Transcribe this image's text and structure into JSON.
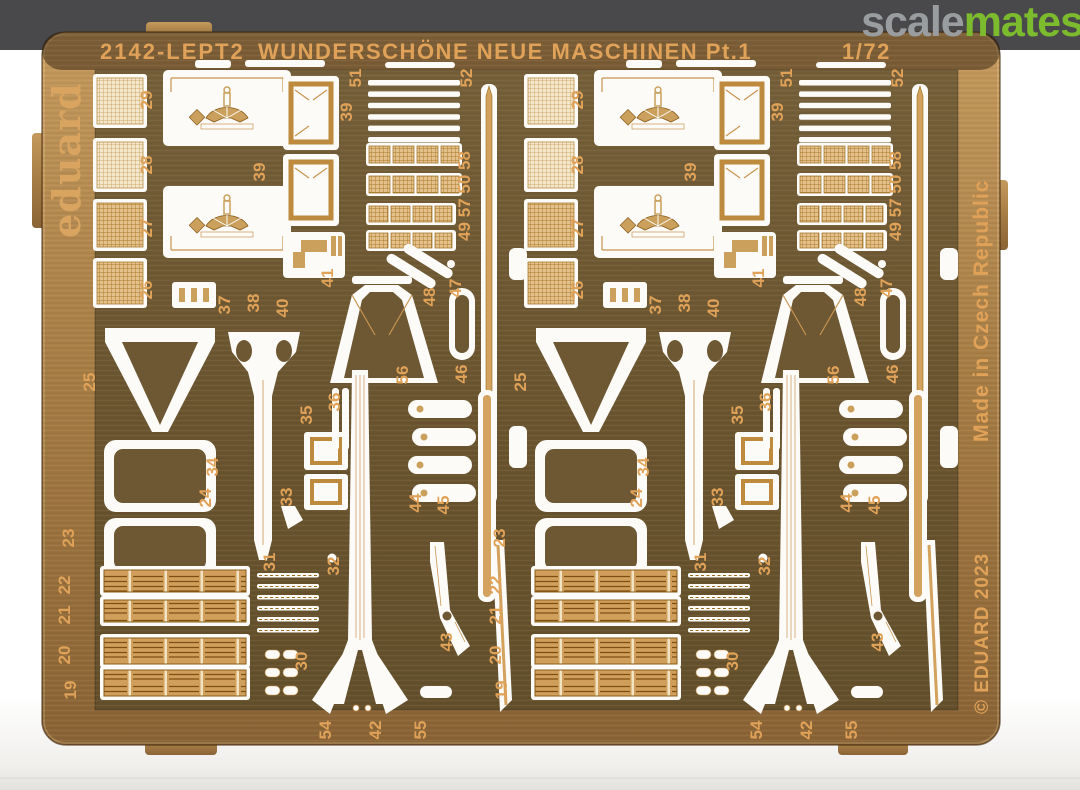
{
  "watermark": {
    "scale": "scale",
    "mates": "mates"
  },
  "board": {
    "code": "2142-LEPT2",
    "title": "WUNDERSCHÖNE NEUE MASCHINEN Pt.1",
    "scale_label": "1/72",
    "brand": "eduard",
    "made_in": "Made in Czech Republic",
    "copyright": "© EDUARD 2023"
  },
  "colors": {
    "band": "#49494b",
    "edge": "#bc9055",
    "field": "#6e5733",
    "etch": "#e0a258",
    "white_part": "#fcfbf7",
    "wm_gray": "#999da0",
    "wm_green": "#7cbb2d"
  },
  "part_labels": [
    {
      "t": "29",
      "x": 57,
      "y": 100
    },
    {
      "t": "28",
      "x": 57,
      "y": 165
    },
    {
      "t": "27",
      "x": 57,
      "y": 228
    },
    {
      "t": "26",
      "x": 57,
      "y": 290
    },
    {
      "t": "39",
      "x": 257,
      "y": 112
    },
    {
      "t": "39",
      "x": 170,
      "y": 172
    },
    {
      "t": "41",
      "x": 238,
      "y": 278
    },
    {
      "t": "51",
      "x": 266,
      "y": 78
    },
    {
      "t": "49 57 50 58",
      "x": 375,
      "y": 196
    },
    {
      "t": "52",
      "x": 377,
      "y": 78
    },
    {
      "t": "47",
      "x": 366,
      "y": 288
    },
    {
      "t": "48",
      "x": 340,
      "y": 297
    },
    {
      "t": "46",
      "x": 372,
      "y": 374
    },
    {
      "t": "56",
      "x": 313,
      "y": 375
    },
    {
      "t": "36",
      "x": 245,
      "y": 402
    },
    {
      "t": "35",
      "x": 217,
      "y": 415
    },
    {
      "t": "37",
      "x": 135,
      "y": 305
    },
    {
      "t": "38",
      "x": 164,
      "y": 303
    },
    {
      "t": "40",
      "x": 193,
      "y": 308
    },
    {
      "t": "25",
      "x": 0,
      "y": 382
    },
    {
      "t": "24",
      "x": 116,
      "y": 498
    },
    {
      "t": "34",
      "x": 123,
      "y": 467
    },
    {
      "t": "33",
      "x": 197,
      "y": 497
    },
    {
      "t": "23",
      "x": -21,
      "y": 538
    },
    {
      "t": "32",
      "x": 244,
      "y": 566
    },
    {
      "t": "31",
      "x": 180,
      "y": 562
    },
    {
      "t": "30",
      "x": 212,
      "y": 661
    },
    {
      "t": "22",
      "x": -25,
      "y": 585
    },
    {
      "t": "21",
      "x": -25,
      "y": 615
    },
    {
      "t": "20",
      "x": -25,
      "y": 655
    },
    {
      "t": "19",
      "x": -19,
      "y": 690
    },
    {
      "t": "44",
      "x": 326,
      "y": 503
    },
    {
      "t": "45",
      "x": 354,
      "y": 505
    },
    {
      "t": "43",
      "x": 357,
      "y": 642
    },
    {
      "t": "54",
      "x": 236,
      "y": 730
    },
    {
      "t": "42",
      "x": 286,
      "y": 730
    },
    {
      "t": "55",
      "x": 331,
      "y": 730
    }
  ]
}
